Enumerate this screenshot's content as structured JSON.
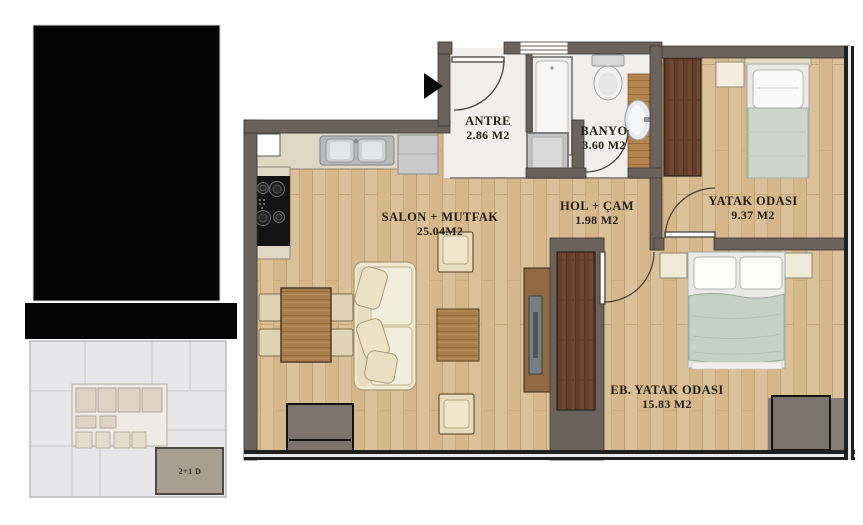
{
  "plan": {
    "type": "apartment-floor-plan",
    "rooms": [
      {
        "id": "antre",
        "name": "ANTRE",
        "area": "2.86 M2"
      },
      {
        "id": "banyo",
        "name": "BANYO",
        "area": "3.60 M2"
      },
      {
        "id": "salon",
        "name": "SALON + MUTFAK",
        "area": "25.04M2"
      },
      {
        "id": "hol",
        "name": "HOL + ÇAM",
        "area": "1.98 M2"
      },
      {
        "id": "yatak",
        "name": "YATAK ODASI",
        "area": "9.37 M2"
      },
      {
        "id": "eb_yatak",
        "name": "EB. YATAK ODASI",
        "area": "15.83 M2"
      }
    ],
    "key_plan": {
      "unit_label": "2+1 D"
    },
    "colors": {
      "wall": "#6b625c",
      "wood_floor": "#d9c095",
      "light_floor": "#f0efee",
      "dark_wood": "#6e4832",
      "blanket": "#c6d1c6",
      "key_unit_highlight": "#a89e91",
      "redaction": "#050505"
    }
  }
}
